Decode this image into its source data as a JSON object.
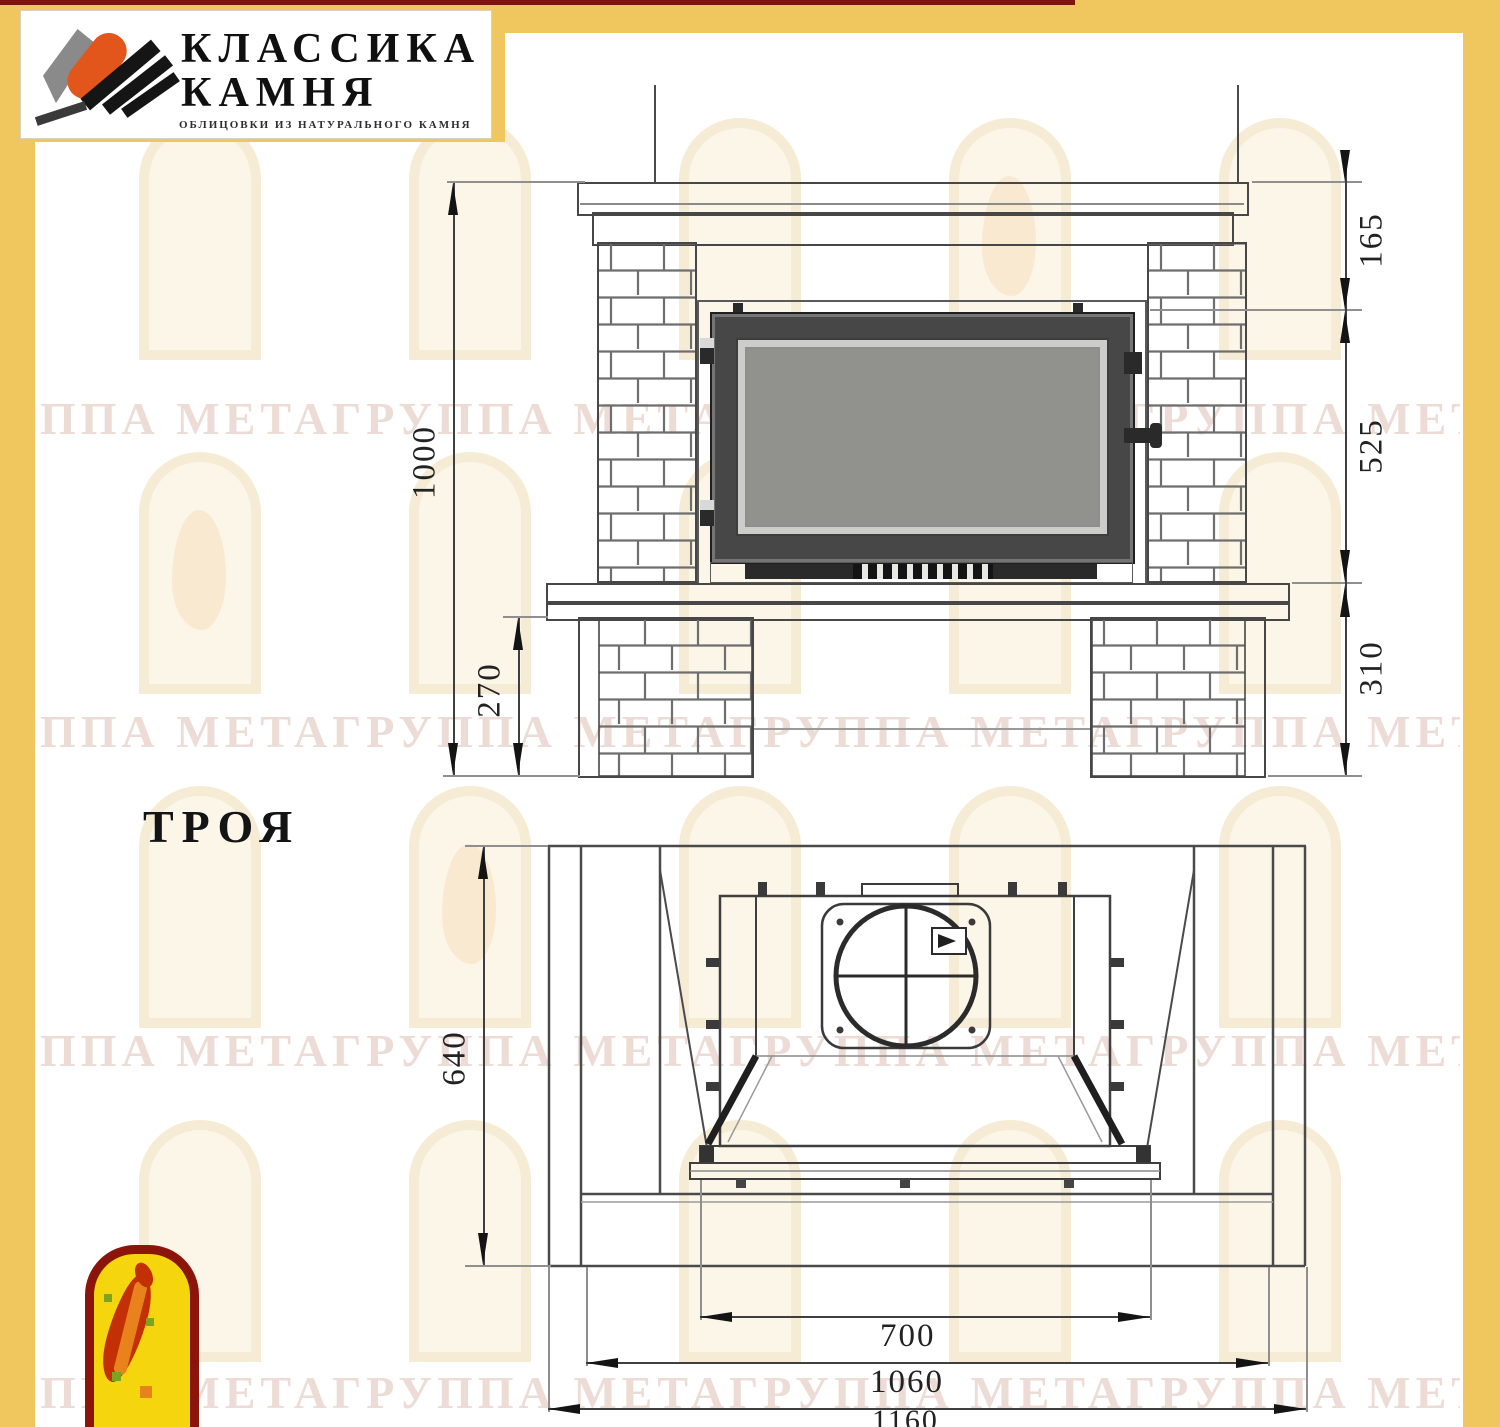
{
  "header": {
    "brand_line1": "КЛАССИКА",
    "brand_line2": "КАМНЯ",
    "tagline": "ОБЛИЦОВКИ ИЗ НАТУРАЛЬНОГО КАМНЯ"
  },
  "title": "ТРОЯ",
  "watermark": {
    "text": "ППА МЕТАГРУППА МЕТАГРУППА МЕТАГРУППА МЕТАГРУППА МЕТА"
  },
  "front_view": {
    "dim_height_total": "1000",
    "dim_mantel_height": "165",
    "dim_firebox_height": "525",
    "dim_base_height": "310",
    "dim_hearth_height": "270"
  },
  "plan_view": {
    "dim_depth": "640",
    "dim_opening_width": "700",
    "dim_inner_width": "1060",
    "dim_overall_width": "1160"
  },
  "colors": {
    "frame_yellow": "#F0C65F",
    "top_stripe_red": "#7E1410",
    "line_gray": "#4a4a4a",
    "emblem_red": "#C33005",
    "emblem_yellow": "#F5D60E",
    "logo_orange": "#E2561B"
  }
}
